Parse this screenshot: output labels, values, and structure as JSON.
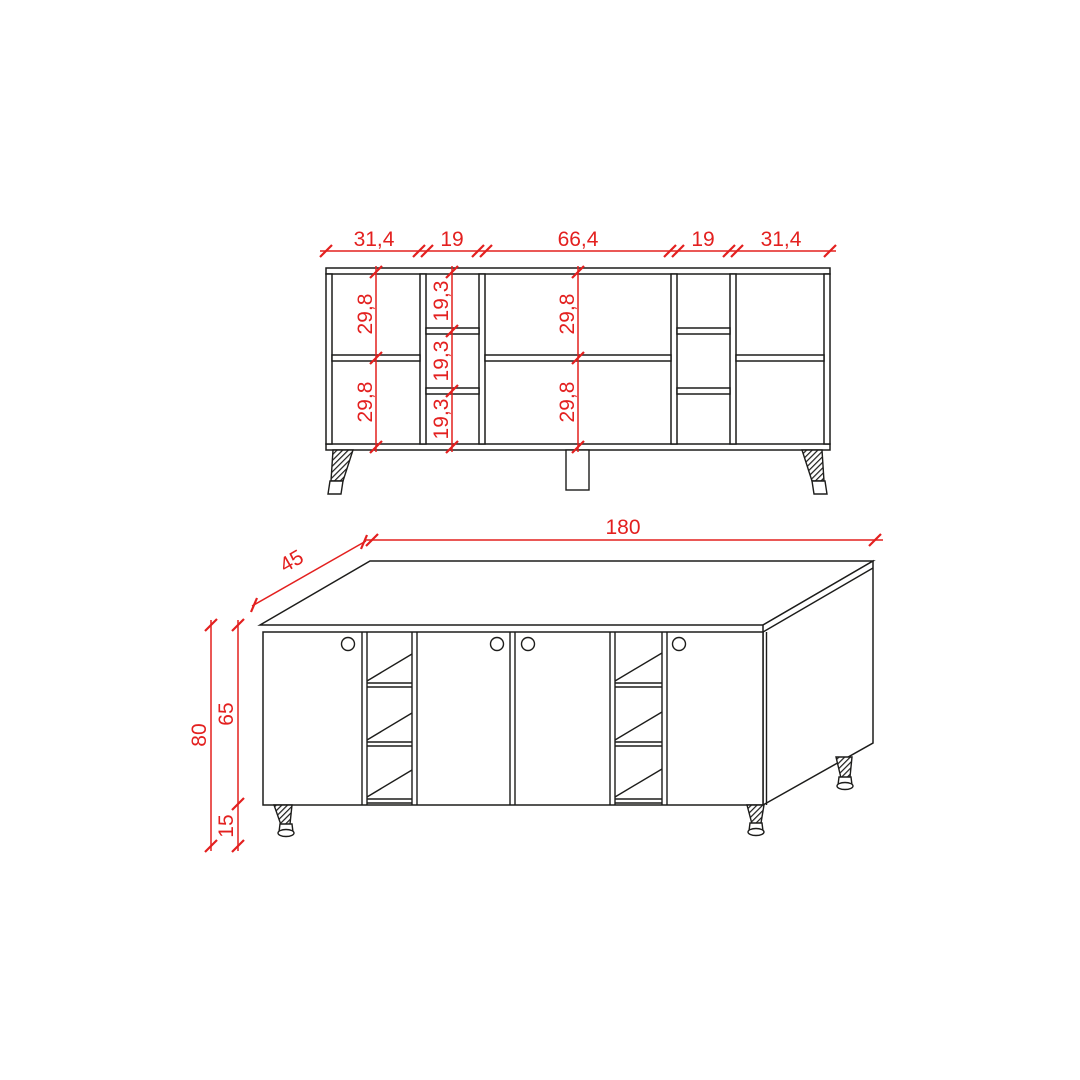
{
  "colors": {
    "red": "#e3201f",
    "black": "#1d1d1b",
    "background": "#ffffff"
  },
  "front_view": {
    "width_dims": [
      "31,4",
      "19",
      "66,4",
      "19",
      "31,4"
    ],
    "col1_dims": [
      "29,8",
      "29,8"
    ],
    "col2_dims": [
      "19,3",
      "19,3",
      "19,3"
    ],
    "col3_dims": [
      "29,8",
      "29,8"
    ]
  },
  "perspective_view": {
    "width": "180",
    "depth": "45",
    "height_total": "80",
    "height_body": "65",
    "height_legs": "15"
  }
}
